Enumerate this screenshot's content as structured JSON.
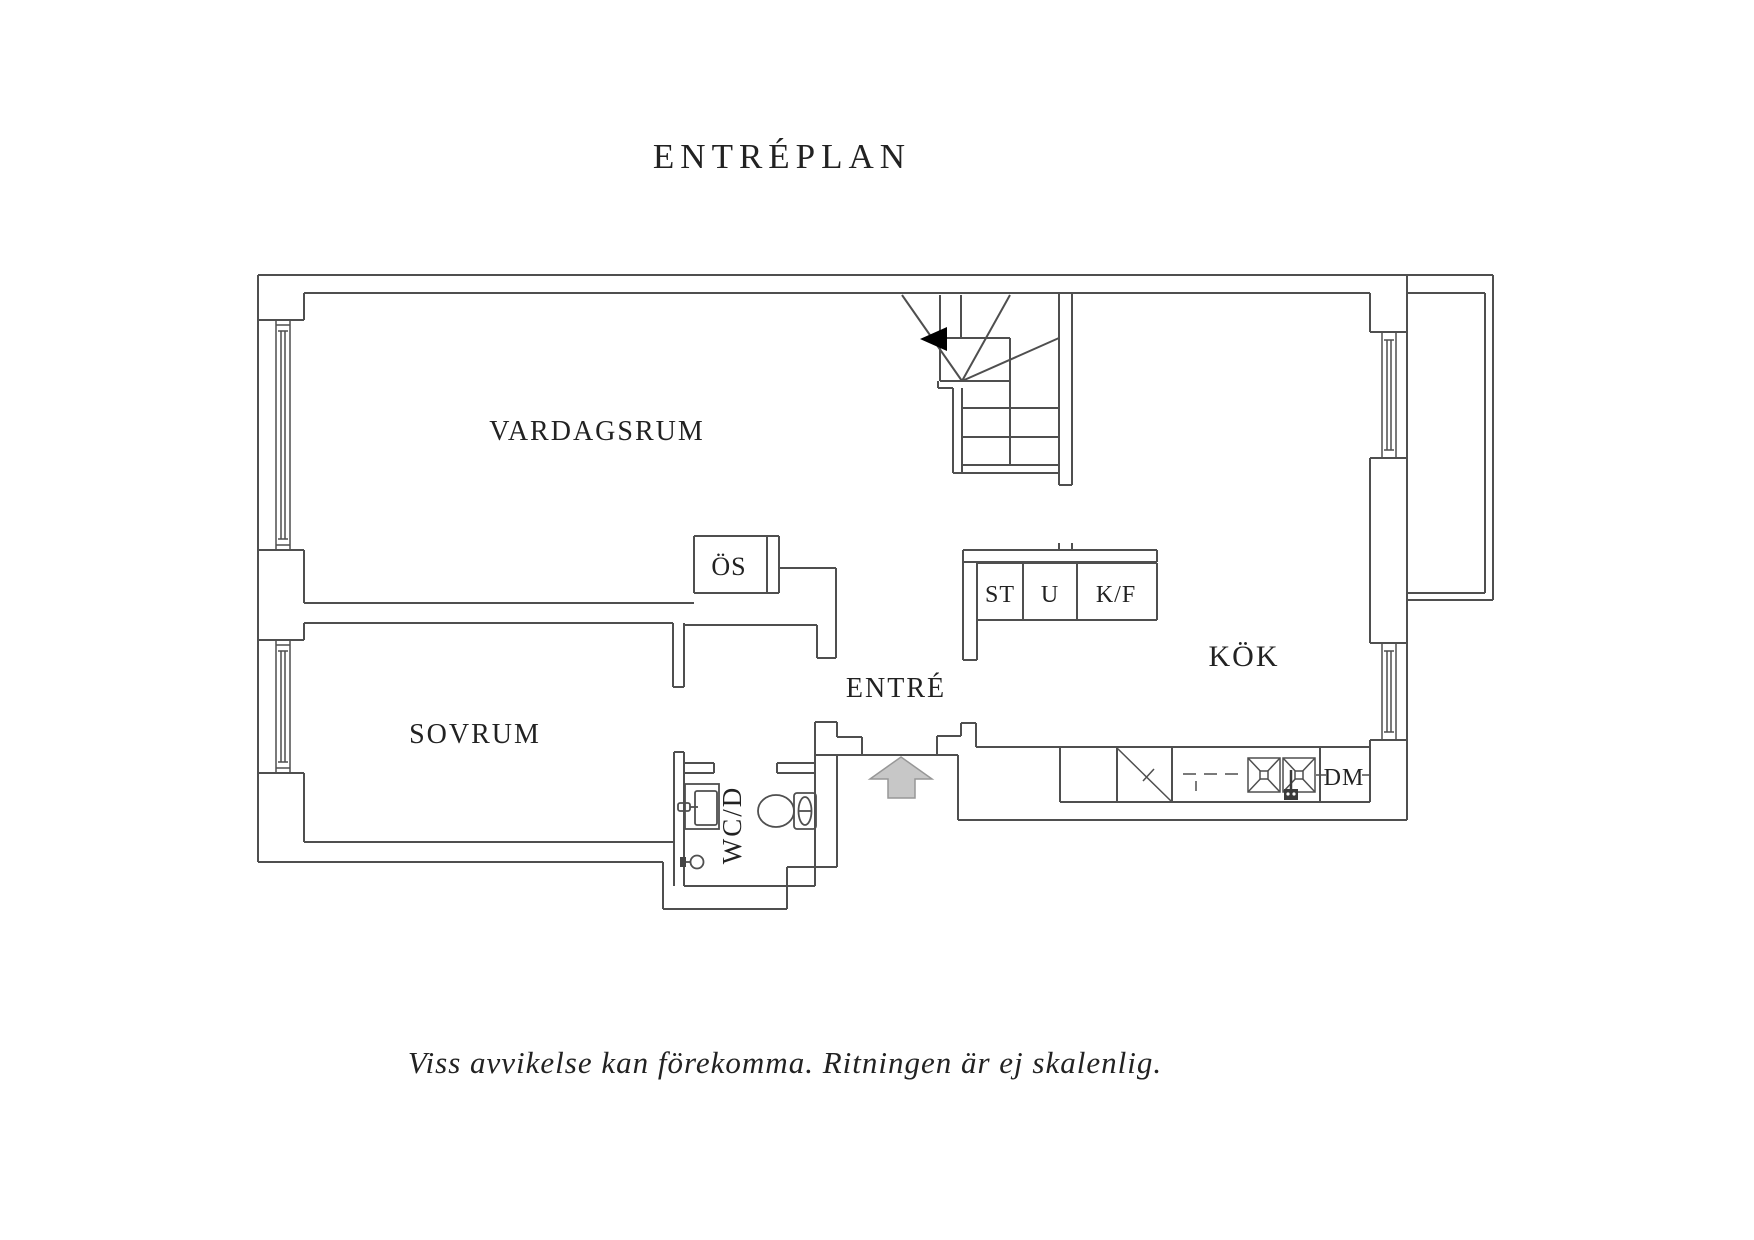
{
  "title": "ENTRÉPLAN",
  "footer": "Viss avvikelse kan förekomma. Ritningen är ej skalenlig.",
  "plan": {
    "rooms": {
      "vardagsrum": "VARDAGSRUM",
      "sovrum": "SOVRUM",
      "kok": "KÖK",
      "entre": "ENTRÉ",
      "wcd": "WC/D",
      "os": "ÖS"
    },
    "appliances": {
      "st": "ST",
      "u": "U",
      "kf": "K/F",
      "dm": "DM"
    }
  },
  "icons": {
    "entry_arrow": "entry-direction-arrow",
    "stair_arrow": "stair-direction-arrow"
  },
  "colors": {
    "wall": "#4f4f4f",
    "text": "#222222",
    "entry_arrow_fill": "#c7c7c7",
    "entry_arrow_stroke": "#979797",
    "stair_arrow_fill": "#000000",
    "background": "#ffffff"
  }
}
